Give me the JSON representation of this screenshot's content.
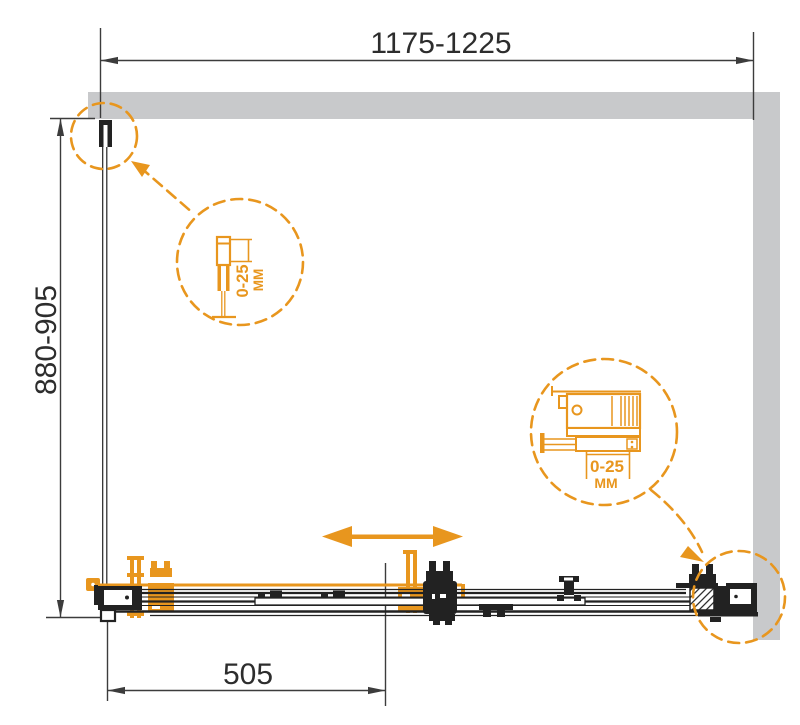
{
  "diagram": {
    "type": "technical-drawing",
    "subject": "Sliding shower door enclosure — installation drawing with adjustment details",
    "dimensions": {
      "top_width": "1175-1225",
      "left_depth": "880-905",
      "bottom_offset": "505"
    },
    "details": {
      "left_profile": {
        "adjustment": "0-25",
        "unit": "ММ"
      },
      "right_profile": {
        "adjustment": "0-25",
        "unit": "ММ"
      }
    },
    "colors": {
      "accent": "#E8961E",
      "ink": "#222222",
      "dim": "#3C3C3C",
      "wall": "#C8C9CB",
      "background": "#FFFFFF"
    }
  }
}
